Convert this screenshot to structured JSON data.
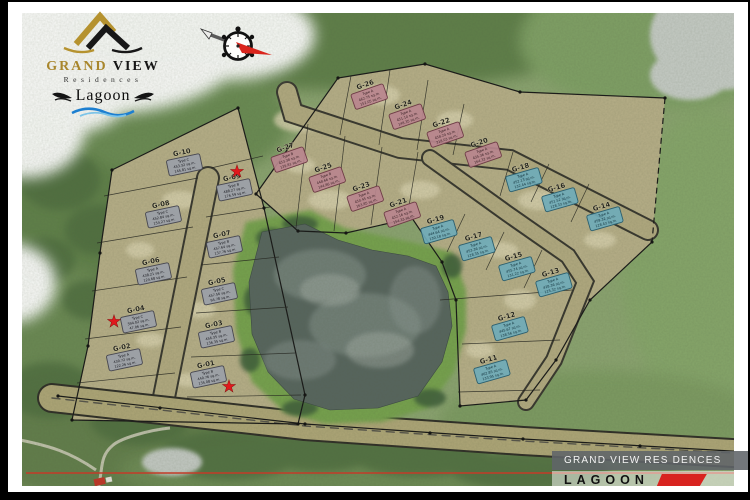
{
  "branding": {
    "grand": "GRAND",
    "view": "VIEW",
    "residences": "Residences",
    "lagoon": "Lagoon"
  },
  "banner": {
    "title": "GRAND VIEW RES DENCES",
    "subtitle": "LAGOON"
  },
  "colors": {
    "accent_red": "#d8231f",
    "logo_gold": "#a8862c",
    "west_box": "#9aa0a8",
    "north_box": "#b9858e",
    "east_box": "#6fabb9"
  },
  "map": {
    "stars": [
      {
        "x": 237,
        "y": 177
      },
      {
        "x": 114,
        "y": 327
      },
      {
        "x": 229,
        "y": 392
      }
    ],
    "clusters": [
      {
        "name": "west",
        "angle": -12,
        "box_fill": "#9aa0a8",
        "box_stroke": "#474750",
        "text_color": "#17171d",
        "lots": [
          {
            "id": "G-10",
            "type": "Type C",
            "a1": "453.32 sq.m.",
            "a2": "145.81 sq.m.",
            "x": 183,
            "y": 158
          },
          {
            "id": "G-09",
            "type": "Type B",
            "a1": "488.27 sq.m.",
            "a2": "176.59 sq.m.",
            "x": 233,
            "y": 183
          },
          {
            "id": "G-08",
            "type": "Type C",
            "a1": "452.84 sq.m.",
            "a2": "154.27 sq.m.",
            "x": 162,
            "y": 210
          },
          {
            "id": "G-07",
            "type": "Type B",
            "a1": "457.64 sq.m.",
            "a2": "137.76 sq.m.",
            "x": 223,
            "y": 240
          },
          {
            "id": "G-06",
            "type": "Type A",
            "a1": "438.21 sq.m.",
            "a2": "124.68 sq.m.",
            "x": 152,
            "y": 267
          },
          {
            "id": "G-05",
            "type": "Type C",
            "a1": "457.56 sq.m.",
            "a2": "94.78 sq.m.",
            "x": 218,
            "y": 287
          },
          {
            "id": "G-04",
            "type": "Type C",
            "a1": "394.02 sq.m.",
            "a2": "47.06 sq.m.",
            "x": 137,
            "y": 315
          },
          {
            "id": "G-03",
            "type": "Type B",
            "a1": "456.35 sq.m.",
            "a2": "136.35 sq.m.",
            "x": 215,
            "y": 330
          },
          {
            "id": "G-02",
            "type": "Type A",
            "a1": "430.72 sq.m.",
            "a2": "122.26 sq.m.",
            "x": 123,
            "y": 353
          },
          {
            "id": "G-01",
            "type": "Type B",
            "a1": "440.76 sq.m.",
            "a2": "135.08 sq.m.",
            "x": 207,
            "y": 370
          }
        ]
      },
      {
        "name": "north",
        "angle": -19,
        "box_fill": "#b9858e",
        "box_stroke": "#6e3c46",
        "text_color": "#371f24",
        "lots": [
          {
            "id": "G-26",
            "type": "Type A",
            "a1": "462.75 sq.m.",
            "a2": "152.05 sq.m.",
            "x": 367,
            "y": 90
          },
          {
            "id": "G-24",
            "type": "Type A",
            "a1": "451.10 sq.m.",
            "a2": "148.35 sq.m.",
            "x": 405,
            "y": 110
          },
          {
            "id": "G-22",
            "type": "Type A",
            "a1": "458.24 sq.m.",
            "a2": "218.03 sq.m.",
            "x": 443,
            "y": 128
          },
          {
            "id": "G-20",
            "type": "Type A",
            "a1": "435.36 sq.m.",
            "a2": "164.32 sq.m.",
            "x": 481,
            "y": 148
          },
          {
            "id": "G-27",
            "type": "Type B",
            "a1": "453.38 sq.m.",
            "a2": "139.81 sq.m.",
            "x": 287,
            "y": 153
          },
          {
            "id": "G-25",
            "type": "Type B",
            "a1": "448.66 sq.m.",
            "a2": "144.86 sq.m.",
            "x": 325,
            "y": 173
          },
          {
            "id": "G-23",
            "type": "Type A",
            "a1": "450.45 sq.m.",
            "a2": "163.85 sq.m.",
            "x": 363,
            "y": 192
          },
          {
            "id": "G-21",
            "type": "Type A",
            "a1": "452.16 sq.m.",
            "a2": "154.33 sq.m.",
            "x": 400,
            "y": 208
          }
        ]
      },
      {
        "name": "east",
        "angle": -16,
        "box_fill": "#6fabb9",
        "box_stroke": "#2c5f6e",
        "text_color": "#0f2e38",
        "lots": [
          {
            "id": "G-18",
            "type": "Type A",
            "a1": "452.13 sq.m.",
            "a2": "132.44 sq.m.",
            "x": 522,
            "y": 173
          },
          {
            "id": "G-16",
            "type": "Type A",
            "a1": "451.52 sq.m.",
            "a2": "128.33 sq.m.",
            "x": 558,
            "y": 193
          },
          {
            "id": "G-14",
            "type": "Type A",
            "a1": "459.32 sq.m.",
            "a2": "128.43 sq.m.",
            "x": 603,
            "y": 212
          },
          {
            "id": "G-19",
            "type": "Type A",
            "a1": "444.64 sq.m.",
            "a2": "130.18 sq.m.",
            "x": 437,
            "y": 225
          },
          {
            "id": "G-17",
            "type": "Type A",
            "a1": "453.36 sq.m.",
            "a2": "128.35 sq.m.",
            "x": 475,
            "y": 242
          },
          {
            "id": "G-15",
            "type": "Type A",
            "a1": "455.74 sq.m.",
            "a2": "131.22 sq.m.",
            "x": 515,
            "y": 262
          },
          {
            "id": "G-13",
            "type": "Type A",
            "a1": "428.36 sq.m.",
            "a2": "125.32 sq.m.",
            "x": 552,
            "y": 278
          },
          {
            "id": "G-12",
            "type": "Type A",
            "a1": "445.67 sq.m.",
            "a2": "138.56 sq.m.",
            "x": 508,
            "y": 322
          },
          {
            "id": "G-11",
            "type": "Type A",
            "a1": "462.85 sq.m.",
            "a2": "133.95 sq.m.",
            "x": 490,
            "y": 365
          }
        ]
      }
    ]
  }
}
